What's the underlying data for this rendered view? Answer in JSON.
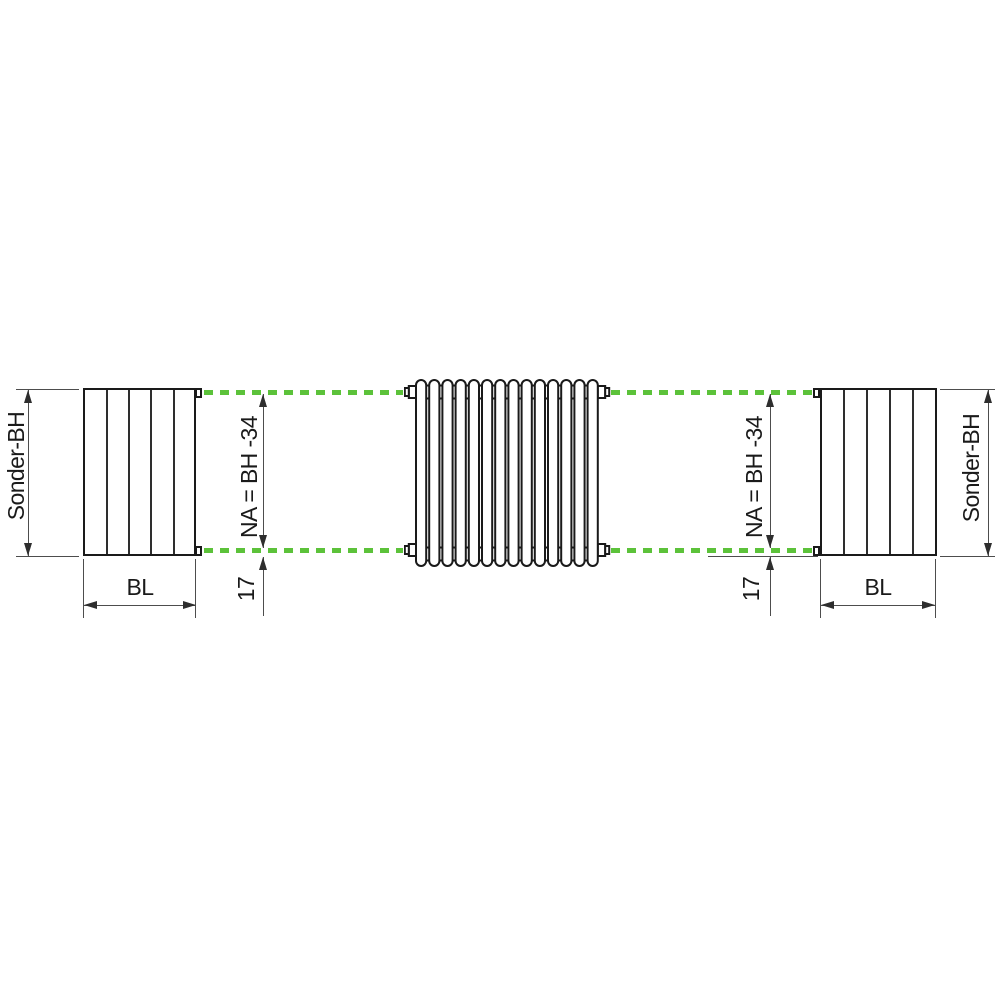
{
  "colors": {
    "accent_green": "#5cc23a",
    "outline_dark": "#1a1a1a",
    "dimension_gray": "#4d4d4d"
  },
  "radiator": {
    "columns": 14
  },
  "labels": {
    "left": {
      "height": "Sonder-BH",
      "width": "BL",
      "nipple_distance": "NA = BH -34",
      "bottom_offset": "17"
    },
    "right": {
      "height": "Sonder-BH",
      "width": "BL",
      "nipple_distance": "NA = BH -34",
      "bottom_offset": "17"
    }
  }
}
